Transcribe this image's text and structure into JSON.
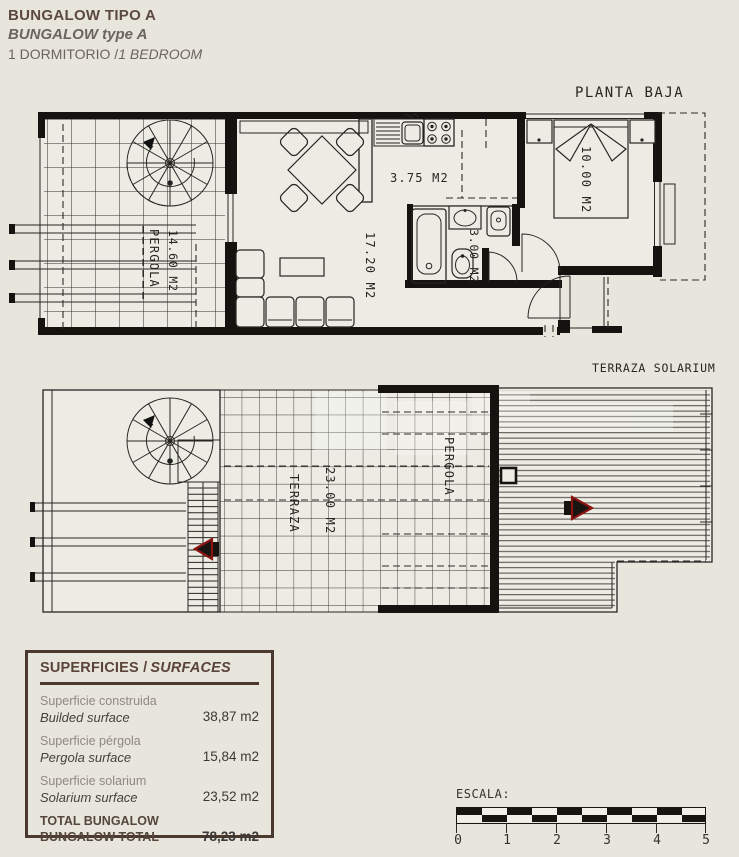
{
  "header": {
    "title": "BUNGALOW TIPO A",
    "title_en": "BUNGALOW type A",
    "bedrooms_es": "1 DORMITORIO /",
    "bedrooms_en": "1 BEDROOM"
  },
  "plans": {
    "ground": {
      "title": "PLANTA BAJA",
      "pergola_name": "PERGOLA",
      "pergola_area": "14.60 M2",
      "living_area": "17.20 M2",
      "kitchen_area": "3.75 M2",
      "bath_area": "3.00 M2",
      "bedroom_area": "10.00 M2"
    },
    "roof": {
      "title": "TERRAZA SOLARIUM",
      "terrace_name": "TERRAZA",
      "terrace_area": "23.00 M2",
      "pergola_name": "PERGOLA"
    }
  },
  "surfaces": {
    "title_es": "SUPERFICIES /",
    "title_en": "SURFACES",
    "rows": [
      {
        "label_es": "Superficie construida",
        "label_en": "Builded surface",
        "value": "38,87 m2"
      },
      {
        "label_es": "Superficie pérgola",
        "label_en": "Pergola surface",
        "value": "15,84 m2"
      },
      {
        "label_es": "Superficie solarium",
        "label_en": "Solarium surface",
        "value": "23,52 m2"
      }
    ],
    "total": {
      "label_es": "TOTAL BUNGALOW",
      "label_en": "BUNGALOW TOTAL",
      "value": "78,23 m2"
    }
  },
  "scale": {
    "label": "ESCALA:",
    "ticks": [
      "0",
      "1",
      "2",
      "3",
      "4",
      "5"
    ]
  },
  "colors": {
    "background": "#e8e5dd",
    "paper_inner": "#edece4",
    "line": "#262522",
    "accent_brown": "#4b382e",
    "arrow_red": "#8d1313"
  }
}
